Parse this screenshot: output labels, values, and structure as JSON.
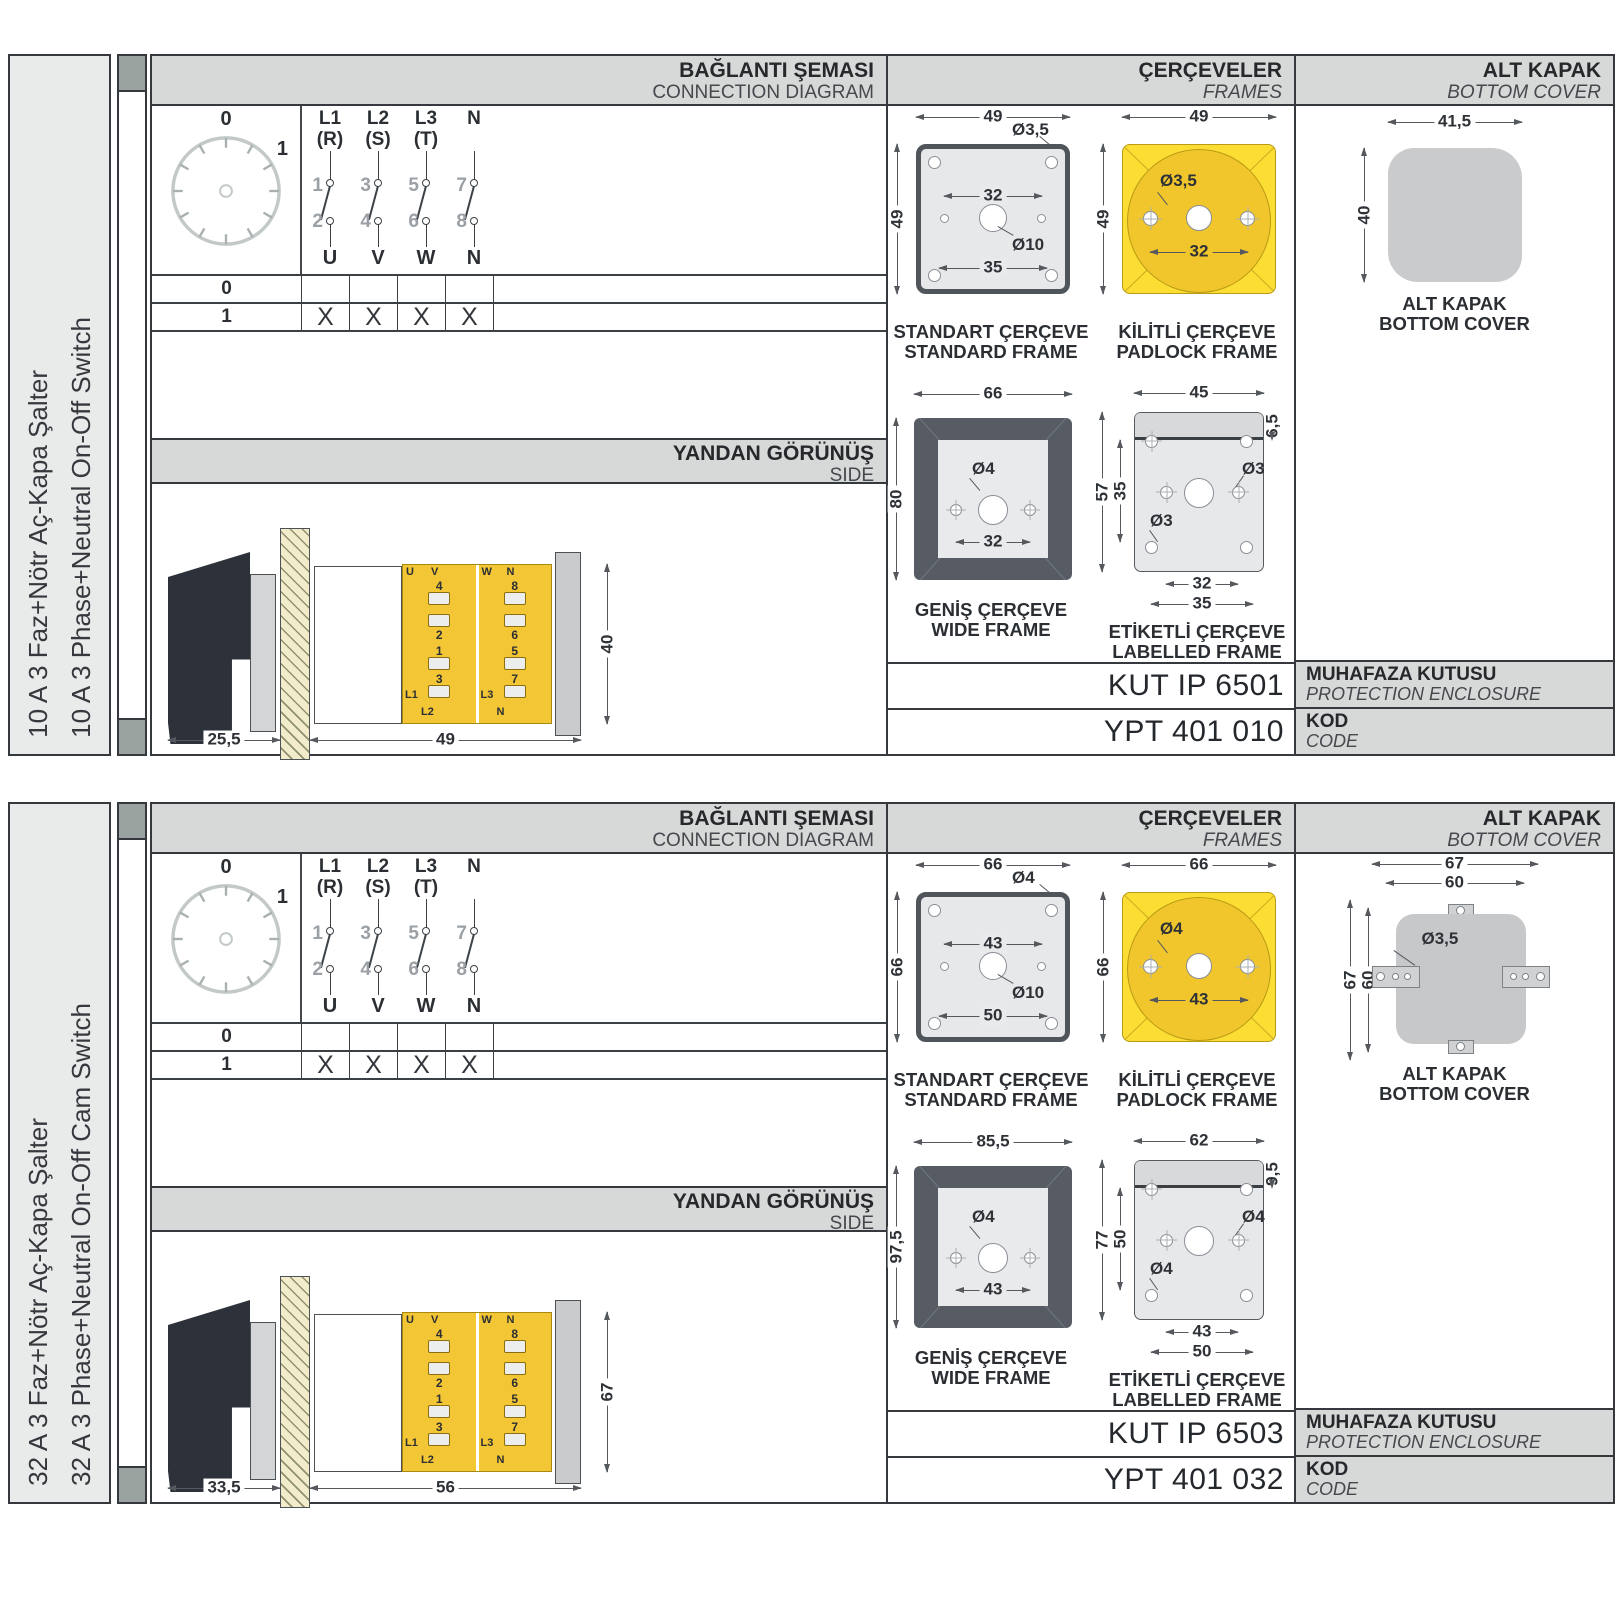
{
  "colors": {
    "accent_yellow": "#fcdd33",
    "accent_yellow_dark": "#f1c52c",
    "header_gray": "#d7d8d8",
    "sidebar_gray": "#e9eaea",
    "frame_gray": "#e7e8ea",
    "wide_frame_dark": "#575c64",
    "cover_gray": "#c9cbcd",
    "border_dark": "#35393e",
    "handle_black": "#2c313a"
  },
  "panels": [
    {
      "sidebar": {
        "title_tr": "10 A 3 Faz+Nötr Aç-Kapa Şalter",
        "title_en": "10 A 3 Phase+Neutral On-Off Switch"
      },
      "headers": {
        "connection_tr": "BAĞLANTI ŞEMASI",
        "connection_en": "CONNECTION DIAGRAM",
        "frames_tr": "ÇERÇEVELER",
        "frames_en": "FRAMES",
        "cover_tr": "ALT KAPAK",
        "cover_en": "BOTTOM COVER"
      },
      "dial": {
        "pos0": "0",
        "pos1": "1"
      },
      "columns": [
        {
          "phase": "L1",
          "phase2": "(R)",
          "in": "1",
          "out": "2",
          "load": "U"
        },
        {
          "phase": "L2",
          "phase2": "(S)",
          "in": "3",
          "out": "4",
          "load": "V"
        },
        {
          "phase": "L3",
          "phase2": "(T)",
          "in": "5",
          "out": "6",
          "load": "W"
        },
        {
          "phase": "N",
          "phase2": "",
          "in": "7",
          "out": "8",
          "load": "N"
        }
      ],
      "table": {
        "rows": [
          {
            "label": "0",
            "marks": [
              "",
              "",
              "",
              ""
            ]
          },
          {
            "label": "1",
            "marks": [
              "X",
              "X",
              "X",
              "X"
            ]
          }
        ]
      },
      "side_view": {
        "title_tr": "YANDAN GÖRÜNÜŞ",
        "title_en": "SIDE",
        "depth": "25,5",
        "width": "49",
        "height": "40",
        "left_top": "U",
        "left_top2": "V",
        "right_top": "W",
        "right_top2": "N",
        "left_nums": [
          "4",
          "2",
          "1",
          "3"
        ],
        "right_nums": [
          "8",
          "6",
          "5",
          "7"
        ],
        "left_bot": "L1",
        "left_bot2": "L2",
        "right_bot": "L3",
        "right_bot2": "N"
      },
      "frames": {
        "standard": {
          "label_tr": "STANDART ÇERÇEVE",
          "label_en": "STANDARD FRAME",
          "w": "49",
          "h": "49",
          "hole": "Ø3,5",
          "center": "Ø10",
          "inner": "32",
          "lower": "35"
        },
        "padlock": {
          "label_tr": "KİLİTLİ ÇERÇEVE",
          "label_en": "PADLOCK FRAME",
          "w": "49",
          "h": "49",
          "hole": "Ø3,5",
          "inner": "32"
        },
        "wide": {
          "label_tr": "GENİŞ ÇERÇEVE",
          "label_en": "WIDE FRAME",
          "w": "66",
          "h": "80",
          "hole": "Ø4",
          "inner": "32"
        },
        "labelled": {
          "label_tr": "ETİKETLİ ÇERÇEVE",
          "label_en": "LABELLED FRAME",
          "w": "45",
          "band": "6,5",
          "h": "57",
          "inner_h": "35",
          "hole": "Ø3",
          "hole2": "Ø3",
          "inner": "32",
          "lower": "35"
        }
      },
      "cover": {
        "label_tr": "ALT KAPAK",
        "label_en": "BOTTOM COVER",
        "w": "41,5",
        "h": "40"
      },
      "codes": {
        "enclosure_value": "KUT IP 6501",
        "enclosure_tr": "MUHAFAZA KUTUSU",
        "enclosure_en": "PROTECTION ENCLOSURE",
        "code_value": "YPT 401 010",
        "code_tr": "KOD",
        "code_en": "CODE"
      }
    },
    {
      "sidebar": {
        "title_tr": "32 A 3 Faz+Nötr Aç-Kapa Şalter",
        "title_en": "32 A 3 Phase+Neutral On-Off Cam Switch"
      },
      "headers": {
        "connection_tr": "BAĞLANTI ŞEMASI",
        "connection_en": "CONNECTION DIAGRAM",
        "frames_tr": "ÇERÇEVELER",
        "frames_en": "FRAMES",
        "cover_tr": "ALT KAPAK",
        "cover_en": "BOTTOM COVER"
      },
      "dial": {
        "pos0": "0",
        "pos1": "1"
      },
      "columns": [
        {
          "phase": "L1",
          "phase2": "(R)",
          "in": "1",
          "out": "2",
          "load": "U"
        },
        {
          "phase": "L2",
          "phase2": "(S)",
          "in": "3",
          "out": "4",
          "load": "V"
        },
        {
          "phase": "L3",
          "phase2": "(T)",
          "in": "5",
          "out": "6",
          "load": "W"
        },
        {
          "phase": "N",
          "phase2": "",
          "in": "7",
          "out": "8",
          "load": "N"
        }
      ],
      "table": {
        "rows": [
          {
            "label": "0",
            "marks": [
              "",
              "",
              "",
              ""
            ]
          },
          {
            "label": "1",
            "marks": [
              "X",
              "X",
              "X",
              "X"
            ]
          }
        ]
      },
      "side_view": {
        "title_tr": "YANDAN GÖRÜNÜŞ",
        "title_en": "SIDE",
        "depth": "33,5",
        "width": "56",
        "height": "67",
        "left_top": "U",
        "left_top2": "V",
        "right_top": "W",
        "right_top2": "N",
        "left_nums": [
          "4",
          "2",
          "1",
          "3"
        ],
        "right_nums": [
          "8",
          "6",
          "5",
          "7"
        ],
        "left_bot": "L1",
        "left_bot2": "L2",
        "right_bot": "L3",
        "right_bot2": "N"
      },
      "frames": {
        "standard": {
          "label_tr": "STANDART ÇERÇEVE",
          "label_en": "STANDARD FRAME",
          "w": "66",
          "h": "66",
          "hole": "Ø4",
          "center": "Ø10",
          "inner": "43",
          "lower": "50"
        },
        "padlock": {
          "label_tr": "KİLİTLİ ÇERÇEVE",
          "label_en": "PADLOCK FRAME",
          "w": "66",
          "h": "66",
          "hole": "Ø4",
          "inner": "43"
        },
        "wide": {
          "label_tr": "GENİŞ ÇERÇEVE",
          "label_en": "WIDE FRAME",
          "w": "85,5",
          "h": "97,5",
          "hole": "Ø4",
          "inner": "43"
        },
        "labelled": {
          "label_tr": "ETİKETLİ ÇERÇEVE",
          "label_en": "LABELLED FRAME",
          "w": "62",
          "band": "9,5",
          "h": "77",
          "inner_h": "50",
          "hole": "Ø4",
          "hole2": "Ø4",
          "inner": "43",
          "lower": "50"
        }
      },
      "cover": {
        "label_tr": "ALT KAPAK",
        "label_en": "BOTTOM COVER",
        "w": "67",
        "w2": "60",
        "h": "67",
        "h2": "60",
        "hole": "Ø3,5"
      },
      "codes": {
        "enclosure_value": "KUT IP 6503",
        "enclosure_tr": "MUHAFAZA KUTUSU",
        "enclosure_en": "PROTECTION ENCLOSURE",
        "code_value": "YPT 401 032",
        "code_tr": "KOD",
        "code_en": "CODE"
      }
    }
  ]
}
